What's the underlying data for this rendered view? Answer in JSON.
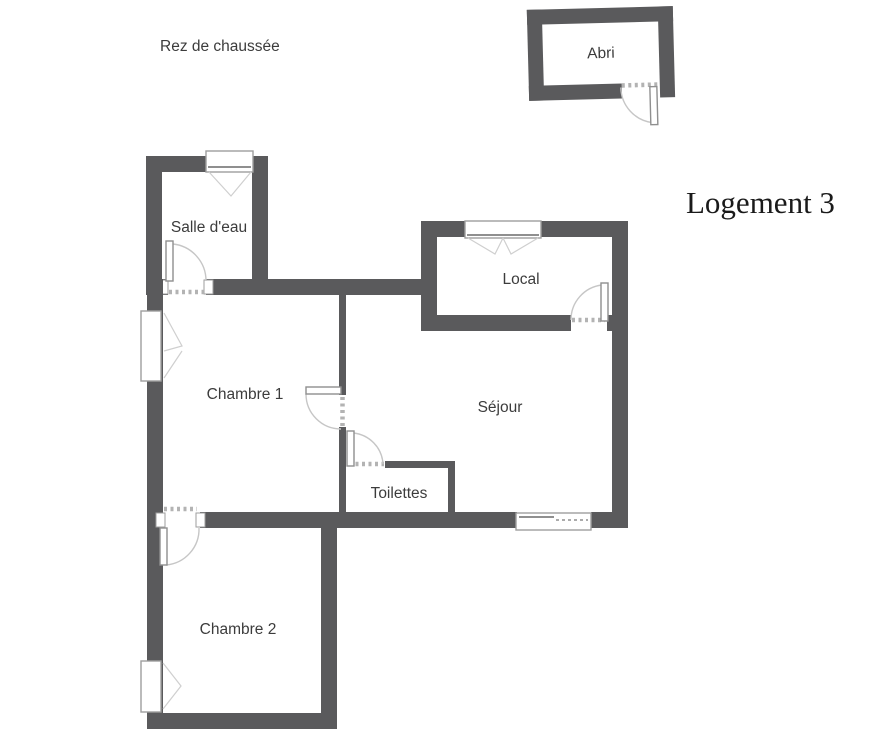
{
  "page": {
    "floor_label": "Rez de chaussée",
    "plan_title": "Logement 3"
  },
  "rooms": {
    "abri": {
      "label": "Abri"
    },
    "salle_deau": {
      "label": "Salle d'eau"
    },
    "local": {
      "label": "Local"
    },
    "chambre1": {
      "label": "Chambre 1"
    },
    "sejour": {
      "label": "Séjour"
    },
    "toilettes": {
      "label": "Toilettes"
    },
    "chambre2": {
      "label": "Chambre 2"
    }
  },
  "colors": {
    "wall": "#5a5a5c",
    "background": "#ffffff",
    "label_text": "#3c3c3c",
    "title_text": "#1a1a1a",
    "door_swing": "#c6c6c6",
    "frame_border": "#9e9e9e",
    "threshold_dash": "#b3b3b3"
  }
}
